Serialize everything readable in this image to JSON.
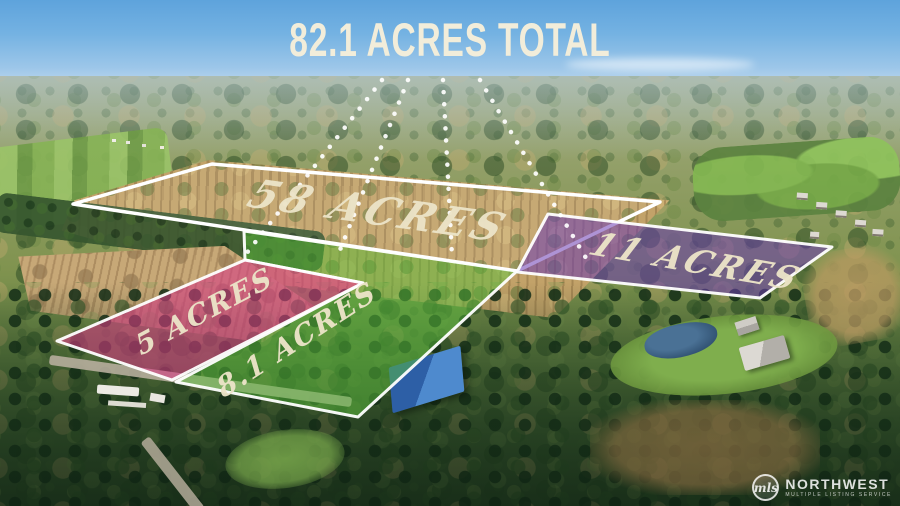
{
  "title": "82.1 ACRES TOTAL",
  "parcels": {
    "p58": {
      "label": "58 ACRES",
      "acres": 58
    },
    "p11": {
      "label": "11 ACRES",
      "acres": 11
    },
    "p5": {
      "label": "5 ACRES",
      "acres": 5
    },
    "p81": {
      "label": "8.1 ACRES",
      "acres": 8.1
    }
  },
  "total_acres": 82.1,
  "colors": {
    "boundary": "#ffffff",
    "fill_11": "#6b3ab2",
    "fill_5": "#d83a84",
    "fill_81": "#59bd3c",
    "label_text": "#ece4c8",
    "title_text": "#f2edda"
  },
  "watermark": {
    "monogram": "mls",
    "brand": "NORTHWEST",
    "tagline": "MULTIPLE LISTING SERVICE"
  }
}
